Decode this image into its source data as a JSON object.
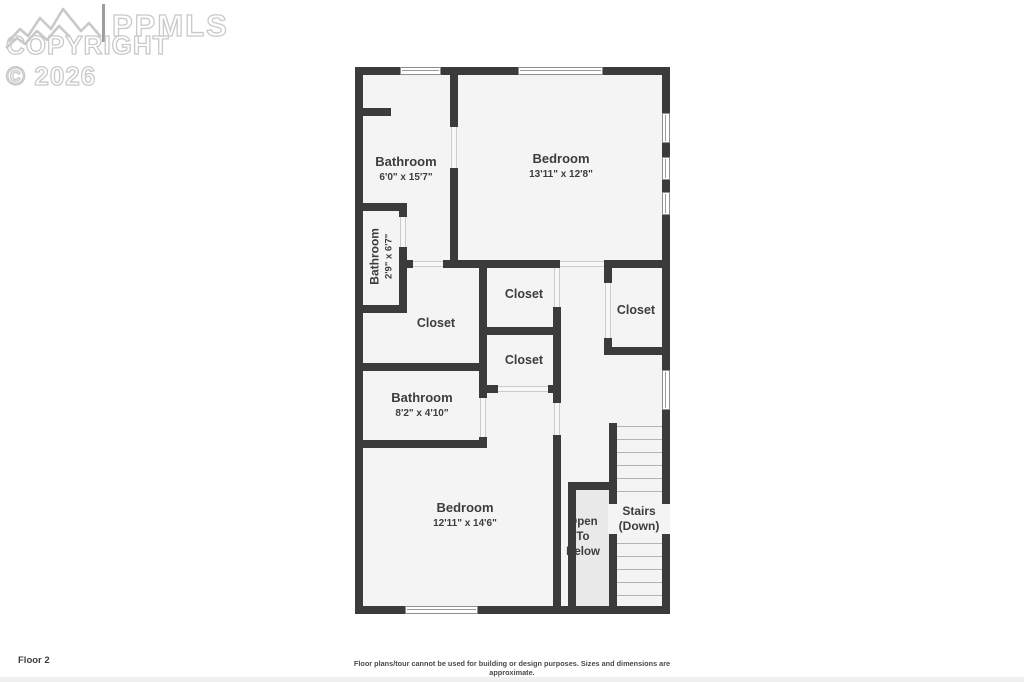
{
  "watermark": {
    "brand": "PPMLS",
    "copyright": "COPYRIGHT © 2026"
  },
  "footer": {
    "floor_label": "Floor 2",
    "disclaimer": "Floor plans/tour cannot be used for building or design purposes. Sizes and dimensions are approximate."
  },
  "colors": {
    "wall": "#3b3b3b",
    "room_fill": "#f4f4f4",
    "open_to_below_fill": "#e9e9e9",
    "label_text": "#3d3d3d",
    "watermark": "#c9c9c9"
  },
  "rooms": {
    "bathroom_top": {
      "name": "Bathroom",
      "dims": "6'0\" x 15'7\""
    },
    "bedroom_top": {
      "name": "Bedroom",
      "dims": "13'11\" x 12'8\""
    },
    "bathroom_small": {
      "name": "Bathroom",
      "dims": "2'9\" x 6'7\""
    },
    "closet_left": {
      "name": "Closet"
    },
    "closet_top_middle": {
      "name": "Closet"
    },
    "closet_right": {
      "name": "Closet"
    },
    "closet_middle": {
      "name": "Closet"
    },
    "bathroom_lower": {
      "name": "Bathroom",
      "dims": "8'2\" x 4'10\""
    },
    "bedroom_bottom": {
      "name": "Bedroom",
      "dims": "12'11\" x 14'6\""
    },
    "open_to_below": {
      "line1": "Open",
      "line2": "To",
      "line3": "Below"
    },
    "stairs": {
      "line1": "Stairs",
      "line2": "(Down)"
    }
  }
}
